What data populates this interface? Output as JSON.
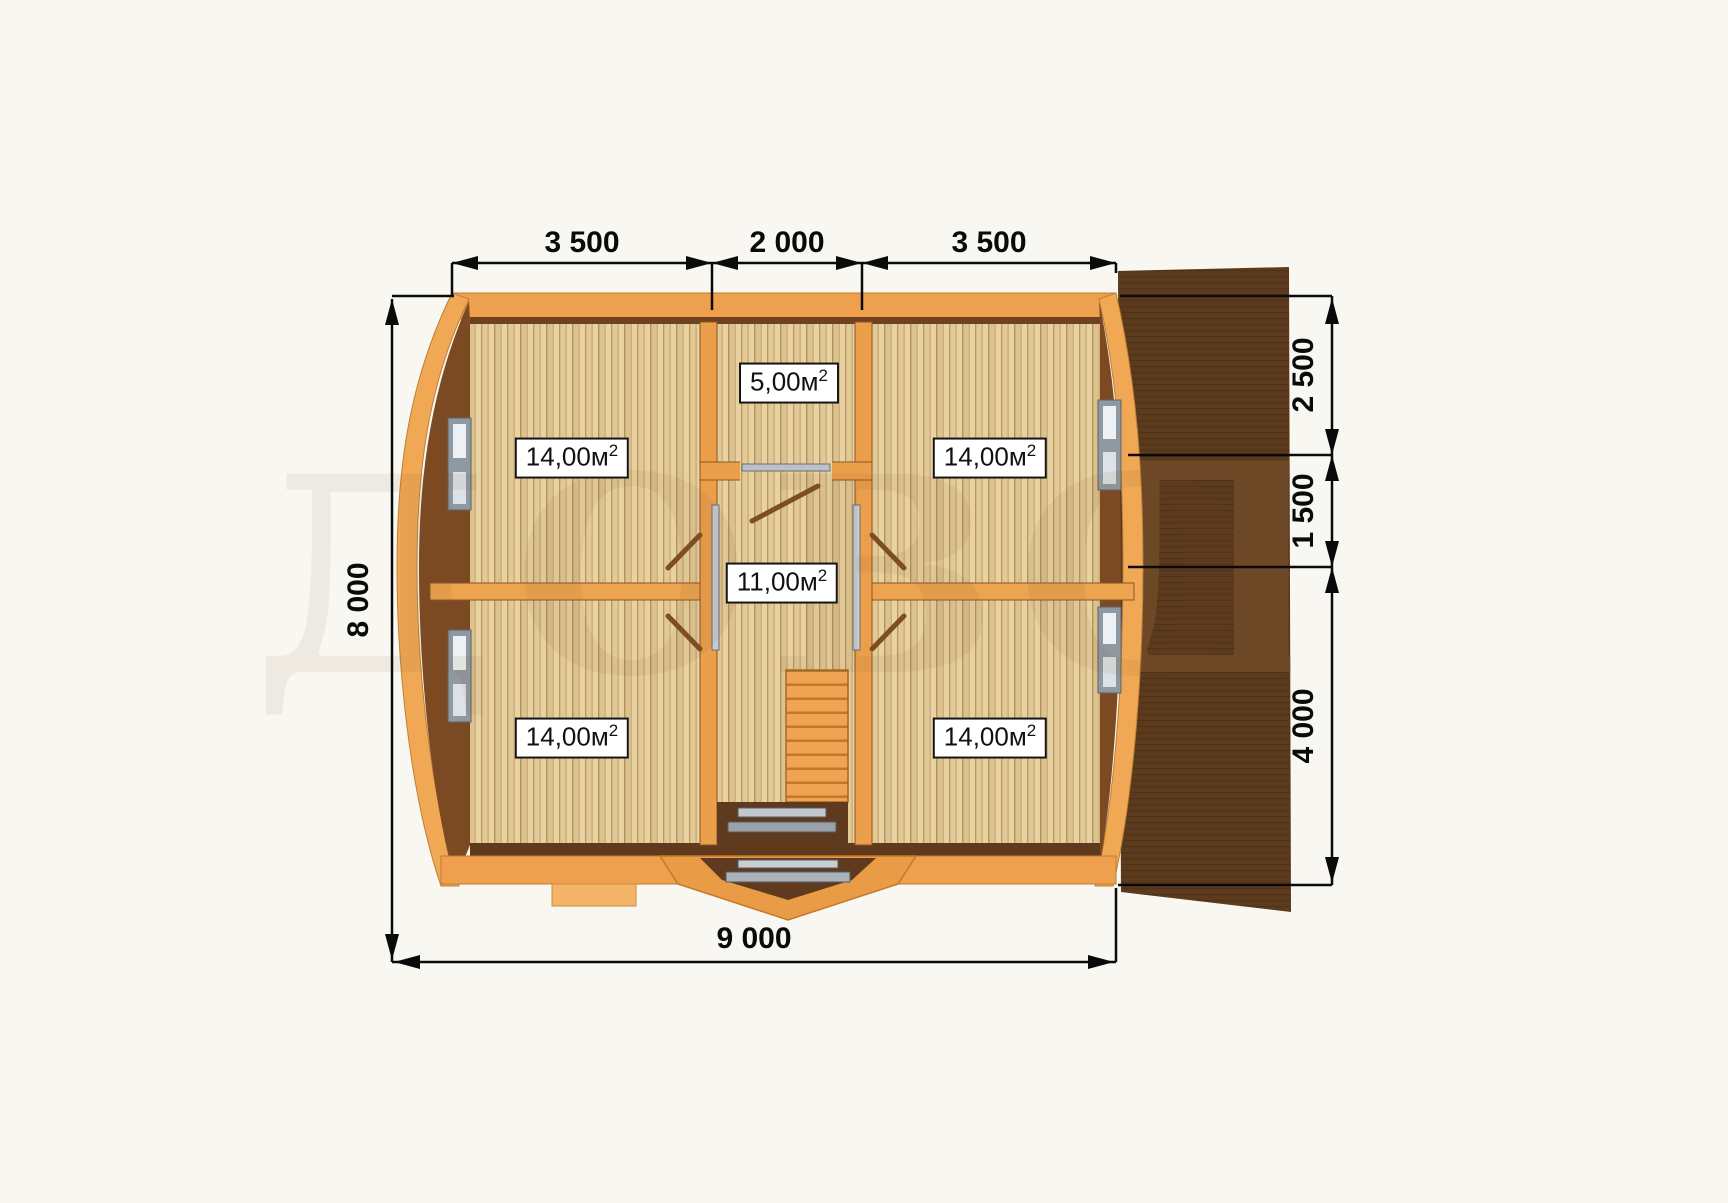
{
  "drawing": {
    "type": "floor-plan",
    "units_note": "м²",
    "dimensions": {
      "top": [
        "3 500",
        "2 000",
        "3 500"
      ],
      "bottom": "9 000",
      "left": "8 000",
      "right": [
        "2 500",
        "1 500",
        "4 000"
      ]
    },
    "rooms": [
      {
        "id": "room-top-left",
        "area": "14,00м",
        "sup": "2"
      },
      {
        "id": "room-top-center",
        "area": "5,00м",
        "sup": "2"
      },
      {
        "id": "room-top-right",
        "area": "14,00м",
        "sup": "2"
      },
      {
        "id": "hall-center",
        "area": "11,00м",
        "sup": "2"
      },
      {
        "id": "room-bottom-left",
        "area": "14,00м",
        "sup": "2"
      },
      {
        "id": "room-bottom-right",
        "area": "14,00м",
        "sup": "2"
      }
    ],
    "watermark": {
      "text": "ДОВОД",
      "plan_part": "ДОВО",
      "roof_part": "Д"
    },
    "colors": {
      "background": "#f9f7f2",
      "wall_orange": "#eea04e",
      "wall_outer_light": "#f1a854",
      "wall_dark_brown": "#7c4a22",
      "floor_light": "#e9d2a2",
      "roof_dark": "#5c3a1e",
      "dimension_line": "#0a0a0a",
      "window_gray": "#c6ccd2",
      "label_background": "#ffffff"
    }
  }
}
